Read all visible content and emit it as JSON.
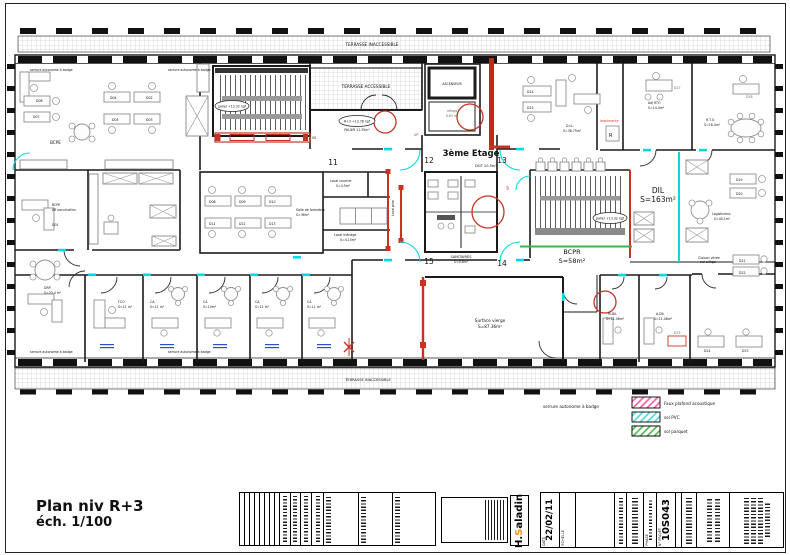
{
  "colors": {
    "wall": "#1b1b1b",
    "cyan": "#00d9e6",
    "red": "#c63323",
    "green": "#3ab54a",
    "pink_hatch": "#ff66a8",
    "logo_orange": "#f7941d"
  },
  "plan": {
    "floor_title": "3ème Etage",
    "grid": {
      "g11": "11",
      "g12": "12",
      "g13": "13",
      "g14": "14",
      "g15": "15"
    },
    "terraces": {
      "top": "TERRASSE INACCESSIBLE",
      "accessible": "TERRASSE ACCESSIBLE",
      "bottom": "TERRASSE INACCESSIBLE"
    },
    "levels": {
      "palier1": "palier +13.32 ngf",
      "palier2": "palier +13.32 ngf",
      "r3": "R+3 +13.78 ngf",
      "palier_area": "PALIER 11.35m²"
    },
    "up1": "UP",
    "up2": "UP",
    "elevator": "ASCENSEUR",
    "refuge_l1": "refuge",
    "refuge_l2": "0.63 m²",
    "rooms": {
      "bcpe_open": "BCPE",
      "bcpe1": "BCPE",
      "bcpe2": "Aff ponctuelles",
      "bcpe3": "D01",
      "formation1": "Salle de formation",
      "formation2": "S=36m²",
      "courrier1": "Local courrier",
      "courrier2": "S=4.5m²",
      "menage1": "Local ménage",
      "menage2": "S=4.15m²",
      "localplan": "Local plan",
      "sanitaires1": "SANITAIRES",
      "sanitaires2": "S=9.8m²",
      "dgt": "DGT 10.5m²",
      "surface1": "Surface vierge",
      "surface2": "S=87.36m²",
      "dil_open1": "DIL",
      "dil_open2": "S=163m²",
      "dil_room1": "D.I.L.",
      "dil_room2": "S=38.75m²",
      "adjrto1": "Adj RTO",
      "adjrto2": "S=14.4m²",
      "rto1": "R.T.O.",
      "rto2": "S=18.4m²",
      "logist1": "Logisticiens",
      "logist2": "S=40.1m²",
      "bcpr1": "BCPR",
      "bcpr2": "S=58m²",
      "drp1": "DRP",
      "drp2": "S=23.4 m²",
      "fco1": "FCO",
      "fco2": "S=11 m²",
      "ca1a": "CA",
      "ca1b": "S=11 m²",
      "ca2a": "CA",
      "ca2b": "S=10m²",
      "ca3a": "CA",
      "ca3b": "S=11 m²",
      "ca4a": "CA",
      "ca4b": "S=11 m²",
      "mdil1": "M.DIL",
      "mdil2": "S=11.08m²",
      "adil1": "A.DIL",
      "adil2": "S=11.08m²",
      "cloison1": "Cloison vitrée",
      "cloison2": "sur allège",
      "imprimante": "Imprimante",
      "printer_r": "R",
      "vs": "VS"
    },
    "desks": {
      "d02": "D02",
      "d03": "D03",
      "d04": "D04",
      "d05": "D05",
      "d06": "D06",
      "d07": "D07",
      "d08": "D08",
      "d09": "D09",
      "d10": "D10",
      "d11": "D11",
      "d12": "D12",
      "d13": "D13",
      "d14": "D14",
      "d15": "D15",
      "d17": "D17",
      "d18": "D18",
      "d19": "D19",
      "d20": "D20",
      "d21": "D21",
      "d22": "D22",
      "d23": "D23",
      "d24": "D24",
      "d25": "D25"
    },
    "annotations": {
      "serrure": "serrure autonome à badge"
    }
  },
  "legend": {
    "note": "serrure autonome à badge",
    "items": [
      {
        "label": "Faux plafond acoustique"
      },
      {
        "label": "sol PVC"
      },
      {
        "label": "sol parquet"
      }
    ]
  },
  "title_block": {
    "plan_title": "Plan niv R+3",
    "scale": "éch. 1/100",
    "date_label": "DATE",
    "date": "22/02/11",
    "scale_label": "ECHELLE",
    "phase_label": "PHASE",
    "project_label": "N° PROJET",
    "project_no": "10S043",
    "logo": {
      "prefix": "H.",
      "accent": "S",
      "suffix": "aladin"
    }
  }
}
